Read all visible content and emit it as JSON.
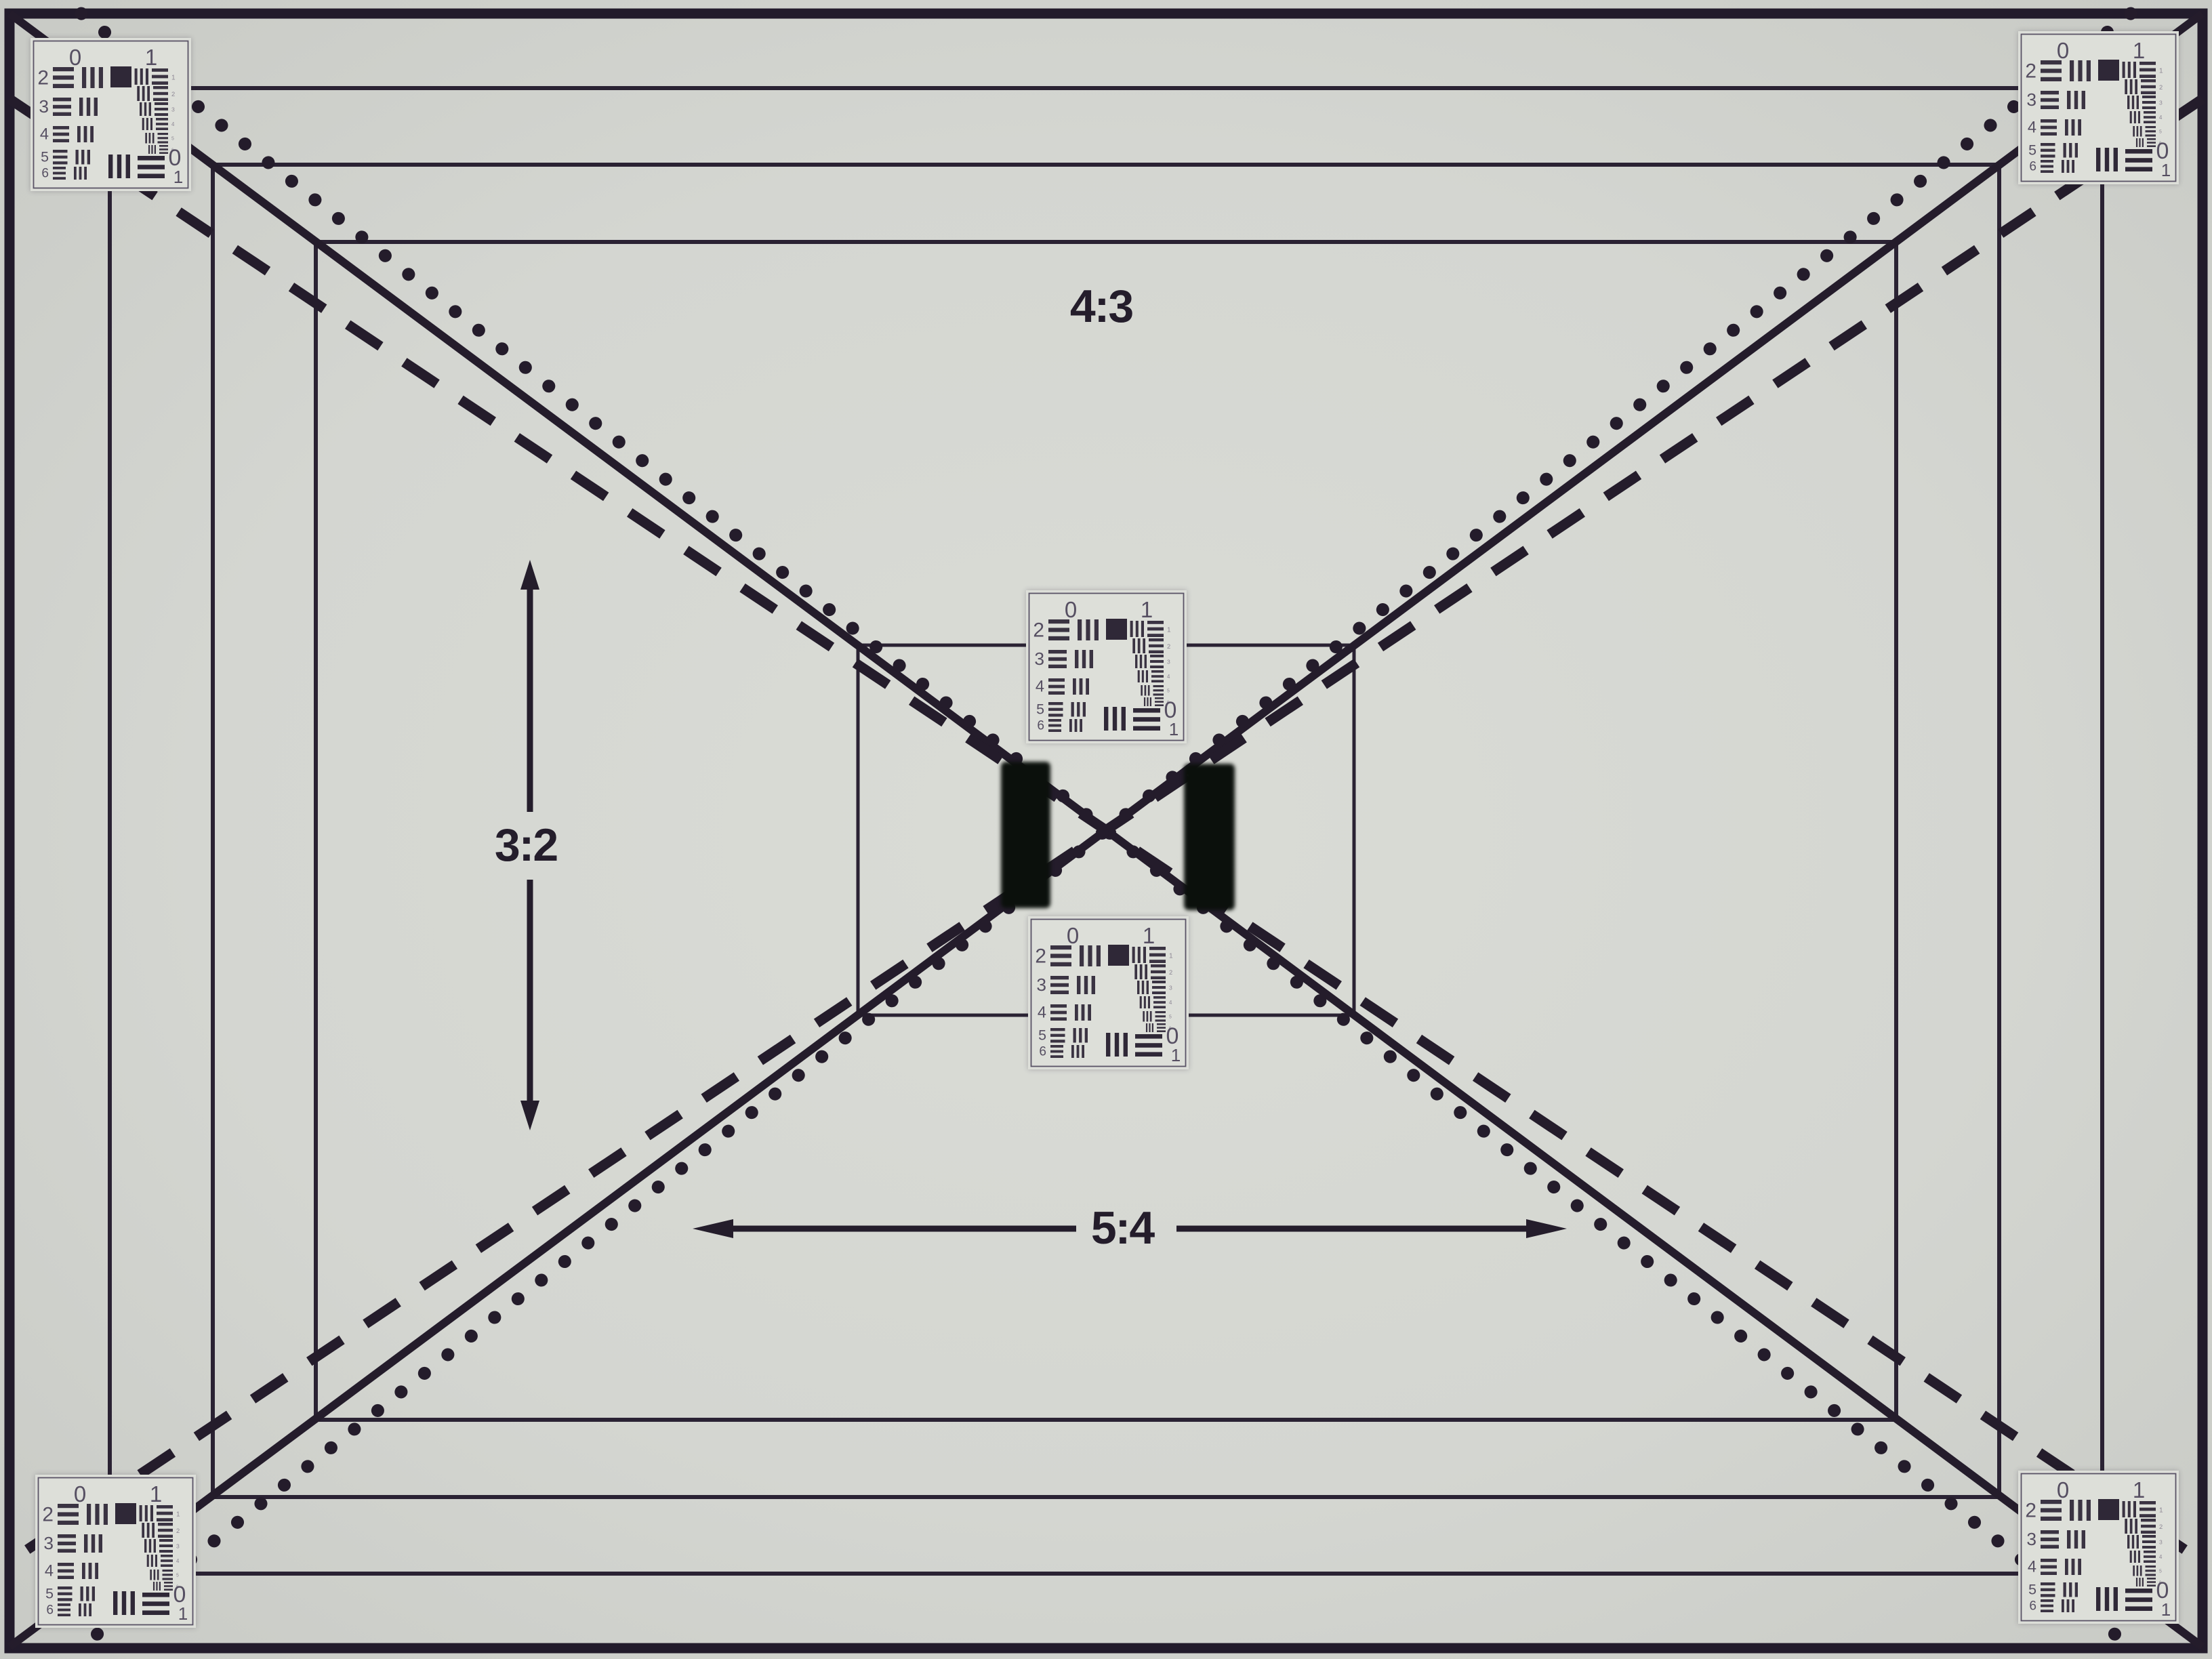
{
  "chart": {
    "description_labels": {
      "aspect_top_center": "4:3",
      "aspect_mid_left": "3:2",
      "aspect_bottom_center": "5:4"
    },
    "colors": {
      "background_center": "#dadcd6",
      "background_mid": "#d4d6d1",
      "background_edge": "#c6c8c3",
      "frame_line": "#2a2233",
      "outer_border": "#221b2b",
      "diagonal_line": "#241c2b",
      "label_ink": "#241d2b",
      "target_card": "#dddfd9",
      "target_border": "#5a5366",
      "target_ink": "#3a3342",
      "target_square": "#2f2837",
      "target_number": "#564f62",
      "target_tiny_number": "#8d8794",
      "velcro_bar": "#0b100c"
    },
    "usaf_target": {
      "top_labels": [
        "0",
        "1"
      ],
      "row_numbers": [
        "2",
        "3",
        "4",
        "5",
        "6"
      ],
      "element_numbers": [
        "1",
        "2",
        "3",
        "4",
        "5",
        "6"
      ],
      "corner_labels": [
        "0",
        "1"
      ]
    },
    "targets": [
      {
        "id": "top-left"
      },
      {
        "id": "top-right"
      },
      {
        "id": "bottom-left"
      },
      {
        "id": "bottom-right"
      },
      {
        "id": "center-upper"
      },
      {
        "id": "center-lower"
      }
    ]
  }
}
